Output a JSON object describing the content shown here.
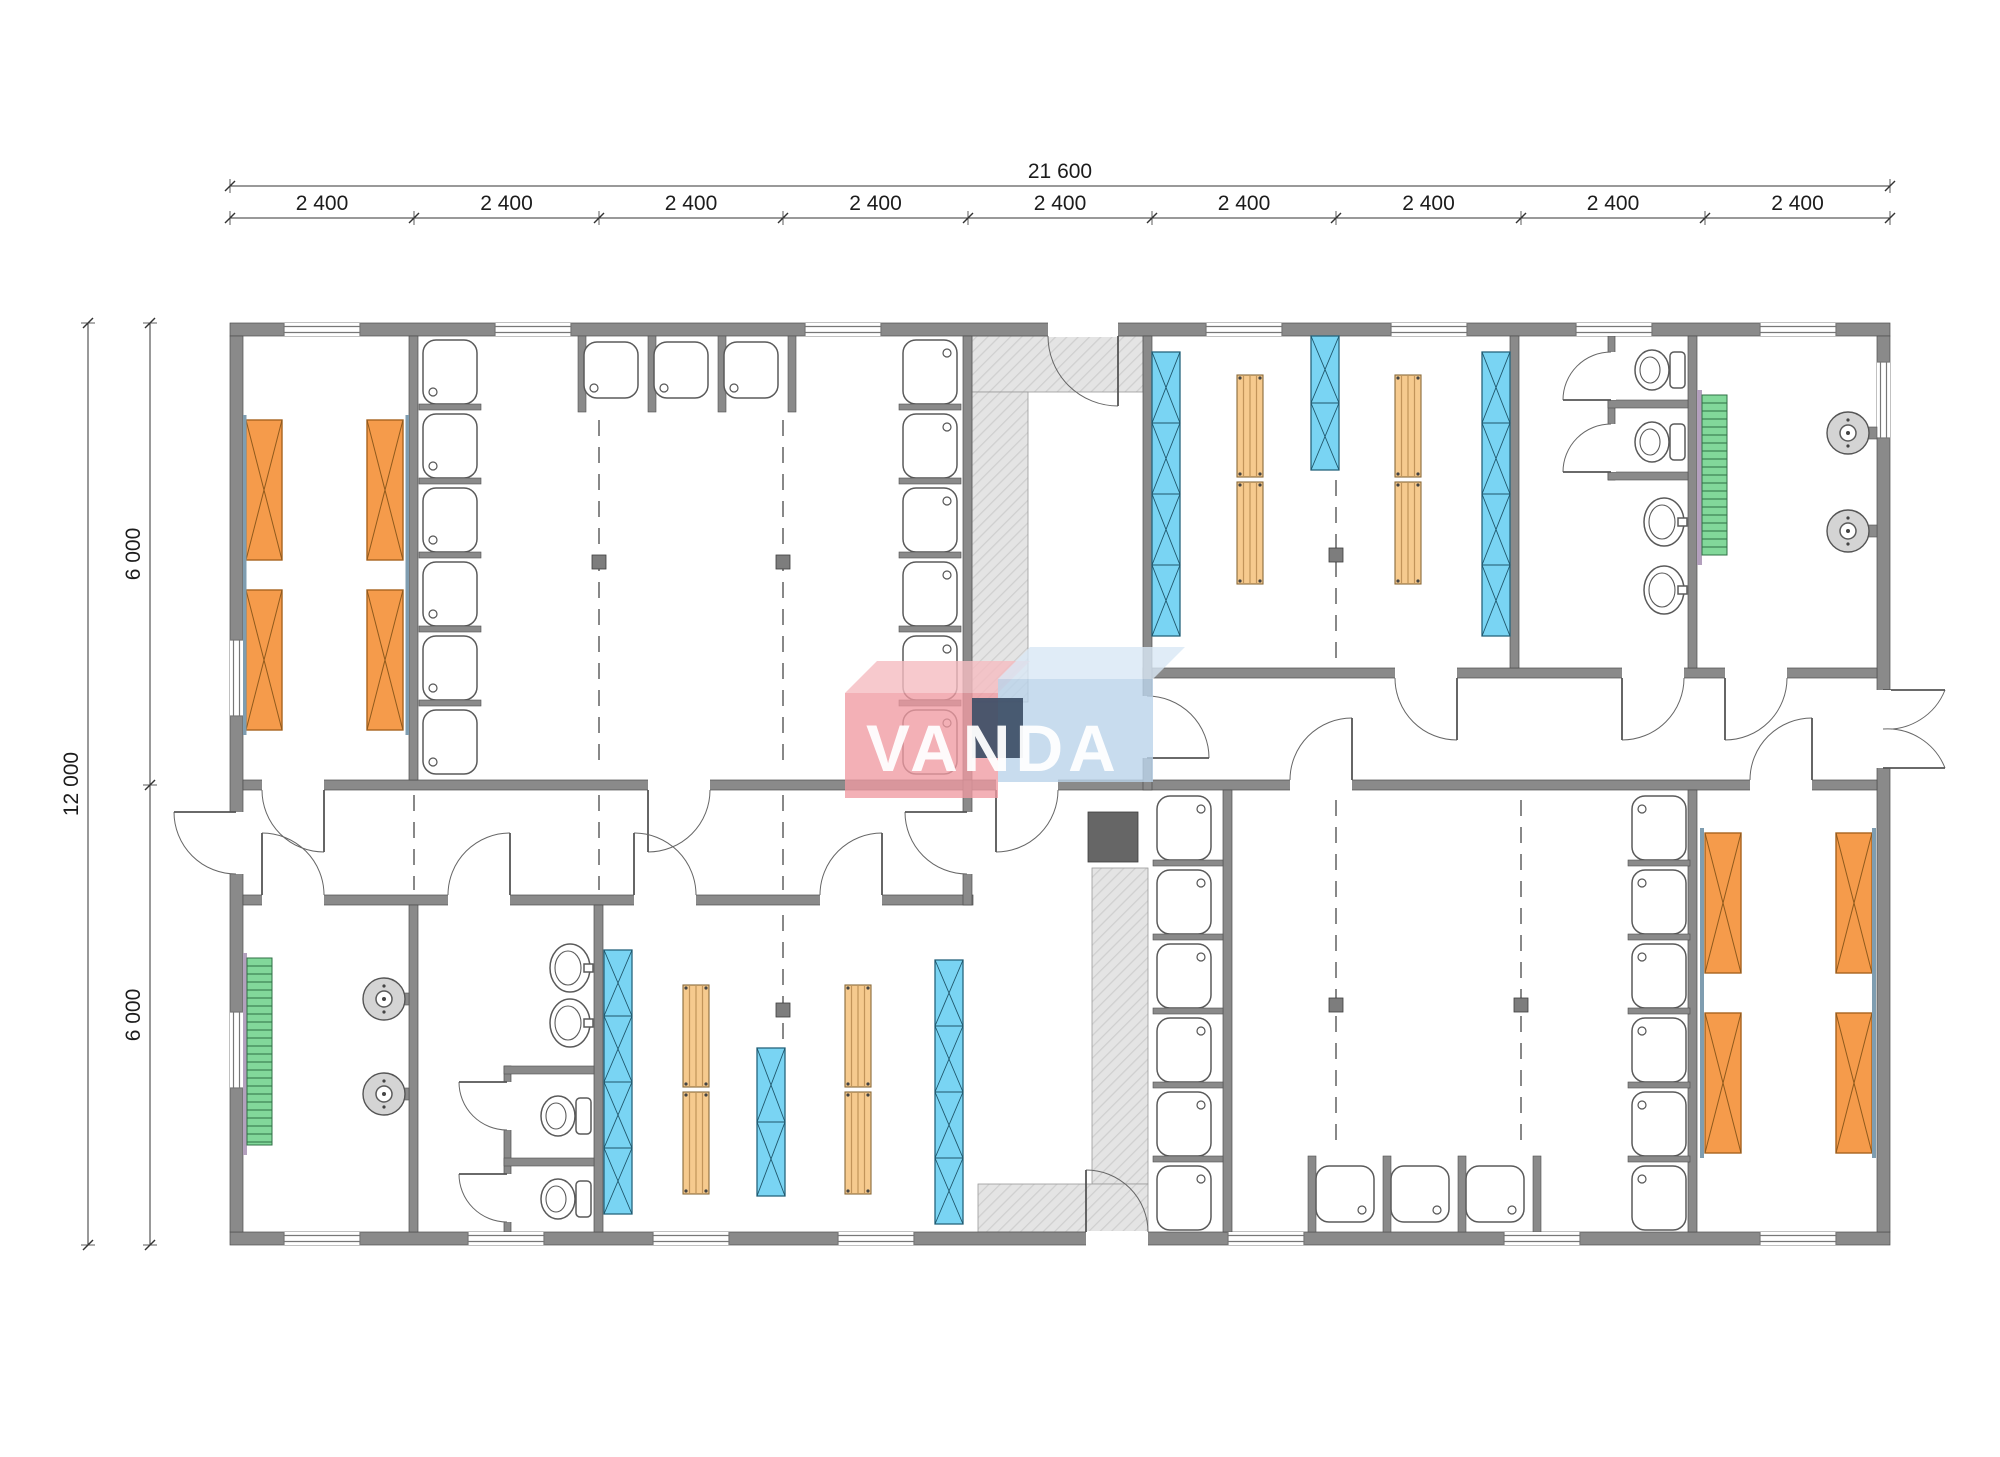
{
  "dimensions": {
    "total_width": "21 600",
    "total_height": "12 000",
    "bays": [
      "2 400",
      "2 400",
      "2 400",
      "2 400",
      "2 400",
      "2 400",
      "2 400",
      "2 400",
      "2 400"
    ],
    "halves": [
      "6 000",
      "6 000"
    ]
  },
  "watermark": {
    "text": "VANDA"
  },
  "colors": {
    "wall_gray": "#8a8a8a",
    "bed_orange": "#f59b4b",
    "locker_blue": "#79d4f3",
    "bench_wood": "#f6ca8e",
    "radiator_green": "#82d89a",
    "platform_hatch_gray": "#e4e4e4",
    "heater_dark": "#666666",
    "logo_pink": "#ef9aa2",
    "logo_light_blue": "#bad3ea",
    "logo_navy": "#3d4e66",
    "dimension_text": "#1c1c1c"
  }
}
